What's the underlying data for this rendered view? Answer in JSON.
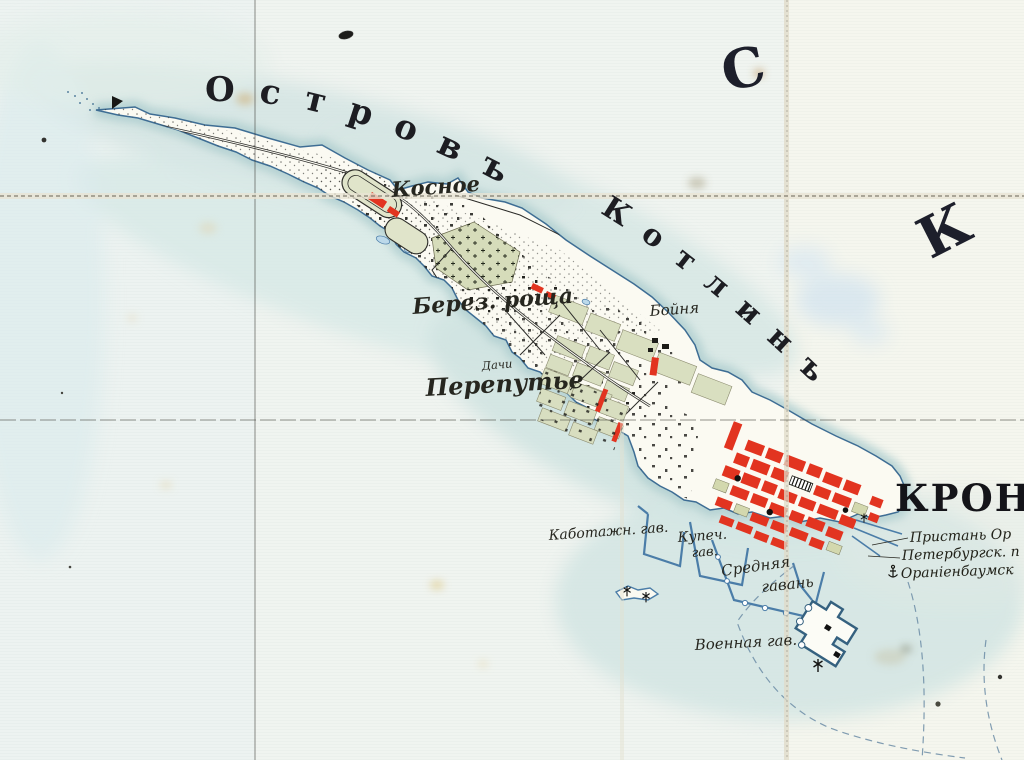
{
  "map": {
    "sea_letters": {
      "c": "С",
      "k": "К"
    },
    "titles": {
      "island_word1": "Островъ",
      "island_word2": "Котлинъ"
    },
    "city": {
      "name_fragment": "КРОНШ"
    },
    "places": {
      "kosnoe": "Косное",
      "berez_roshcha": "Берез. роща",
      "dachi": "Дачи",
      "pereputye": "Перепутье",
      "boynya": "Бойня"
    },
    "harbors": {
      "kabotazhnaya": "Каботажн. гав.",
      "kupecheskaya_line1": "Купеч.",
      "kupecheskaya_line2": "гав.",
      "srednyaya_line1": "Средняя",
      "srednyaya_line2": "гавань",
      "voennaya": "Военная гав."
    },
    "pier_notes": {
      "line1": "Пристань Ор",
      "line2": "Петербургск. п",
      "line3": "Ораніенбаумск"
    },
    "colors": {
      "paper": "#f2f5f1",
      "sea_wash": "#d5e6e4",
      "coastline": "#3e6d94",
      "island_fill": "#fbfaf2",
      "field_green": "#d9dfc0",
      "building_red": "#e23420",
      "harbor_wall_blue": "#4b7da8",
      "ink": "#23221f"
    }
  }
}
